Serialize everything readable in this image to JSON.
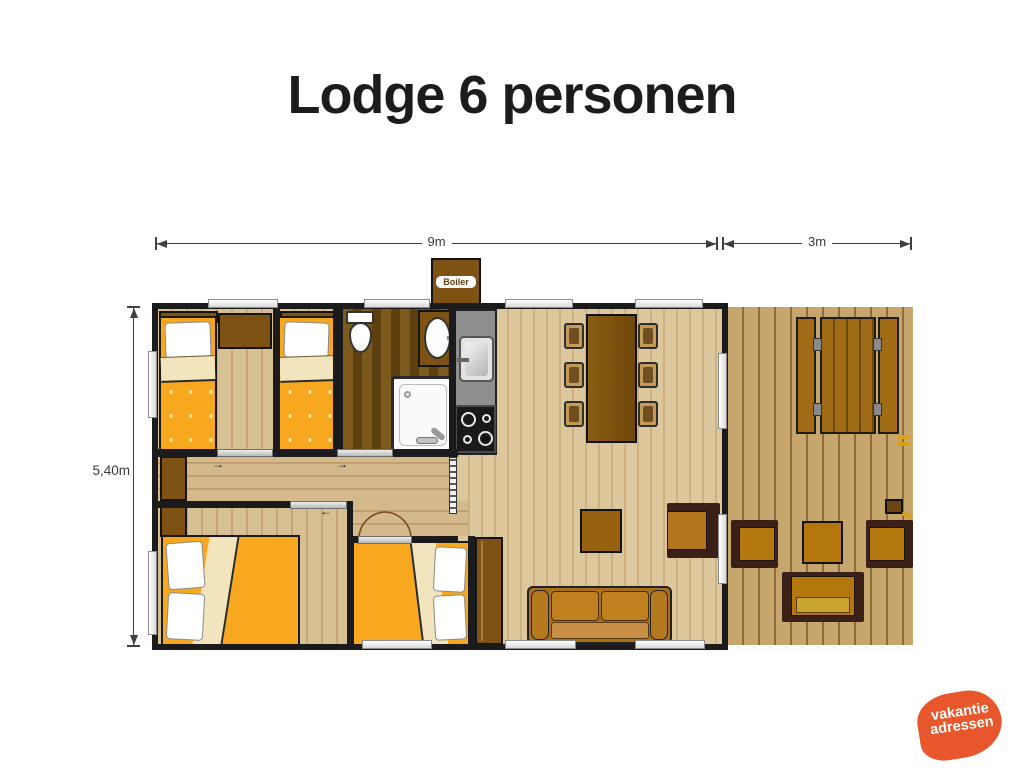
{
  "title": "Lodge 6 personen",
  "dimensions": {
    "main_width": "9m",
    "deck_width": "3m",
    "depth": "5,40m"
  },
  "boiler": {
    "label": "Boiler"
  },
  "logo": {
    "line1": "vakantie",
    "line2": "adressen",
    "color": "#e8572b"
  },
  "colors": {
    "wall": "#1b1b1b",
    "bed_cover": "#f7a81f",
    "wood_furniture": "#7e5212",
    "floor_light": "#d8c095",
    "floor_bathroom": "#7c5a1e",
    "deck_wood": "#c6a66c",
    "kitchen_counter": "#8f8f8f",
    "logo_orange": "#e8572b"
  }
}
